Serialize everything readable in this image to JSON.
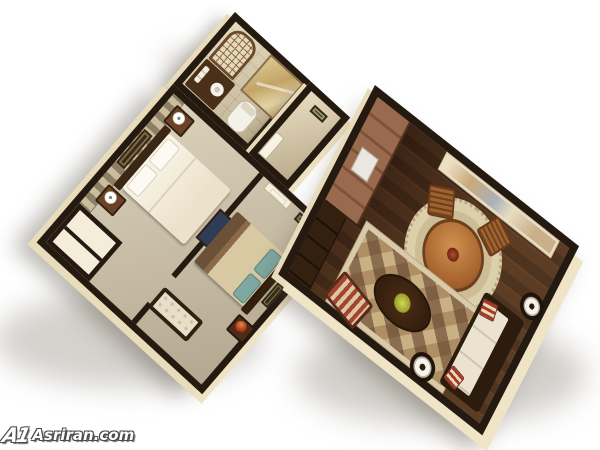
{
  "watermark": {
    "logo": "A1",
    "text": "Asriran.com"
  },
  "scene": {
    "type": "3d-floorplan-render",
    "description": "Isometric 3D cutaway rendering of a one-bedroom-plus-den apartment floor plan on a white background, two angled wings connected by a hallway",
    "palette": {
      "background": "#ffffff",
      "wall_top": "#241a10",
      "wall_exterior_cream": "#e9dcba",
      "bedroom_carpet": "#cfc3ab",
      "hardwood_floor": "#42281a",
      "striped_wallpaper_light": "#cbbd9c",
      "striped_wallpaper_dark": "#8d7e66",
      "linen_white": "#f1ead7",
      "teal_pillow": "#7fa8a2",
      "accent_red_stripe": "#a34330",
      "dining_wood": "#a8652f",
      "plant_green": "#a3aa33"
    },
    "rooms": [
      {
        "name": "bathroom",
        "features": [
          "arched lattice mirror",
          "vanity with sink and towels",
          "tiled shower",
          "toilet"
        ]
      },
      {
        "name": "entry-hall",
        "features": [
          "white door",
          "small art frame"
        ]
      },
      {
        "name": "master-bedroom",
        "features": [
          "striped accent wall",
          "double bed with white linens",
          "two nightstands with white lamps",
          "wall art",
          "closet with shelves"
        ]
      },
      {
        "name": "second-bedroom",
        "features": [
          "white panel door",
          "bed with tan spread and teal pillows",
          "nightstands with gourd lamps",
          "tufted bench",
          "landscape frames",
          "dark blue frame"
        ]
      },
      {
        "name": "kitchen",
        "features": [
          "wood cabinets",
          "white sink",
          "dark console"
        ]
      },
      {
        "name": "dining-area",
        "features": [
          "round wood table with centerpiece",
          "two wood chairs",
          "round woven rug",
          "large abstract wall art"
        ]
      },
      {
        "name": "living-area",
        "features": [
          "harlequin diamond rug",
          "cream sofa with striped pillows",
          "oval coffee table with plant",
          "two round side tables with lamps",
          "striped ottoman"
        ]
      }
    ]
  }
}
